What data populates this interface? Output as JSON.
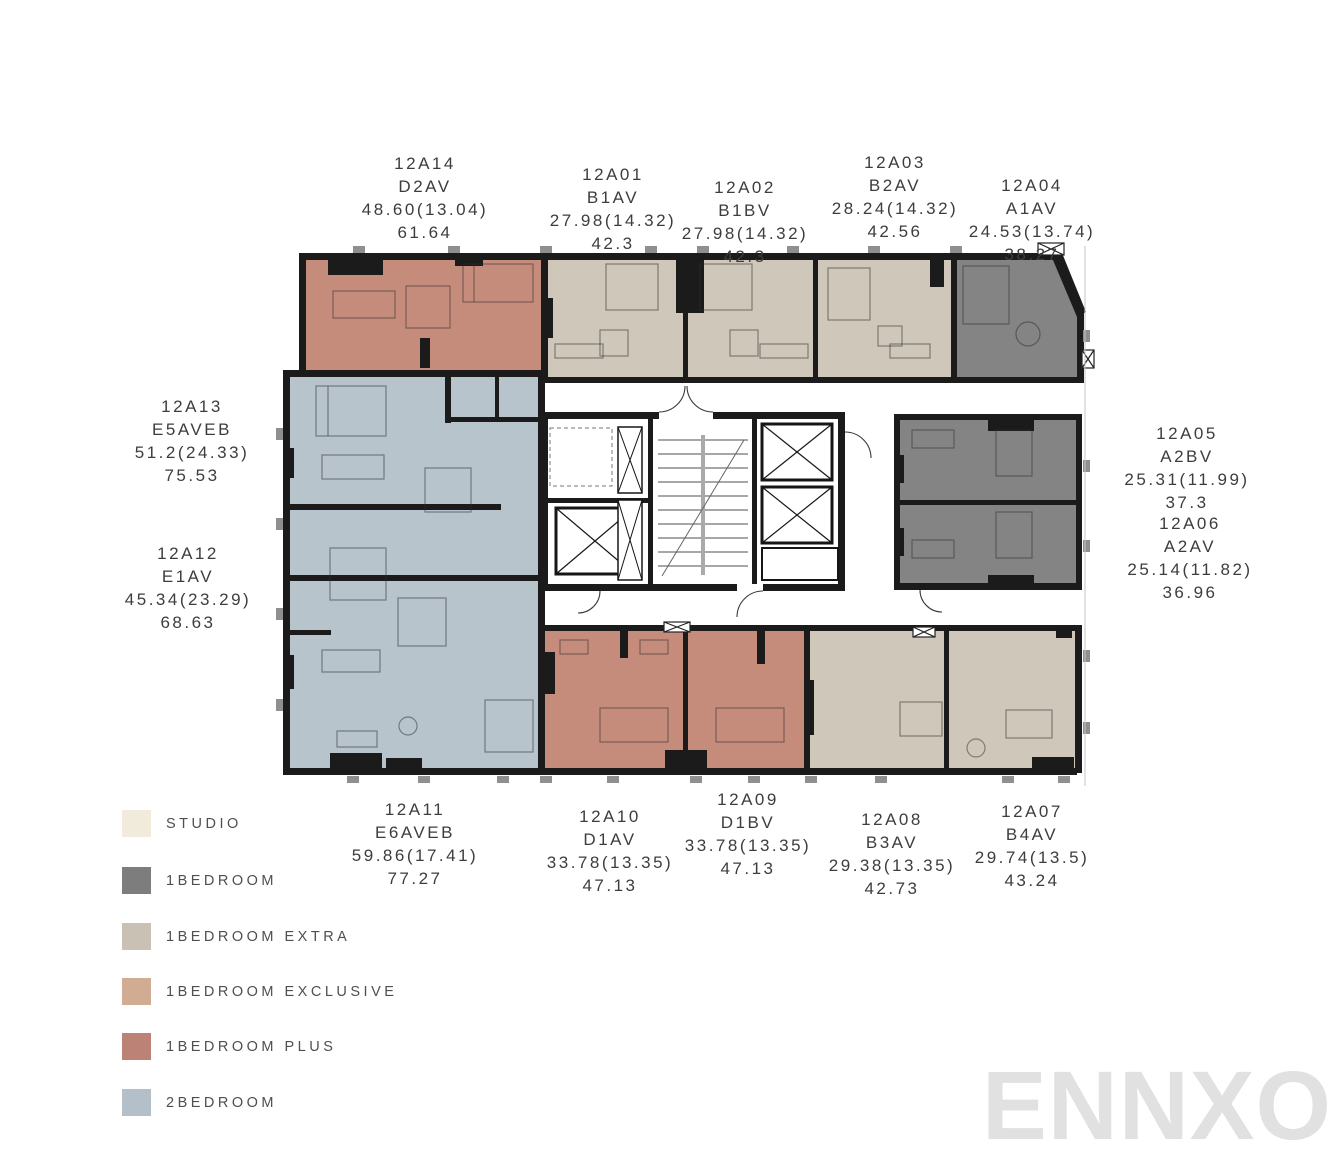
{
  "units": {
    "u01": {
      "id": "12A01",
      "type": "B1AV",
      "area": "27.98(14.32)",
      "total": "42.3"
    },
    "u02": {
      "id": "12A02",
      "type": "B1BV",
      "area": "27.98(14.32)",
      "total": "42.3"
    },
    "u03": {
      "id": "12A03",
      "type": "B2AV",
      "area": "28.24(14.32)",
      "total": "42.56"
    },
    "u04": {
      "id": "12A04",
      "type": "A1AV",
      "area": "24.53(13.74)",
      "total": "38.27"
    },
    "u05": {
      "id": "12A05",
      "type": "A2BV",
      "area": "25.31(11.99)",
      "total": "37.3"
    },
    "u06": {
      "id": "12A06",
      "type": "A2AV",
      "area": "25.14(11.82)",
      "total": "36.96"
    },
    "u07": {
      "id": "12A07",
      "type": "B4AV",
      "area": "29.74(13.5)",
      "total": "43.24"
    },
    "u08": {
      "id": "12A08",
      "type": "B3AV",
      "area": "29.38(13.35)",
      "total": "42.73"
    },
    "u09": {
      "id": "12A09",
      "type": "D1BV",
      "area": "33.78(13.35)",
      "total": "47.13"
    },
    "u10": {
      "id": "12A10",
      "type": "D1AV",
      "area": "33.78(13.35)",
      "total": "47.13"
    },
    "u11": {
      "id": "12A11",
      "type": "E6AVEB",
      "area": "59.86(17.41)",
      "total": "77.27"
    },
    "u12": {
      "id": "12A12",
      "type": "E1AV",
      "area": "45.34(23.29)",
      "total": "68.63"
    },
    "u13": {
      "id": "12A13",
      "type": "E5AVEB",
      "area": "51.2(24.33)",
      "total": "75.53"
    },
    "u14": {
      "id": "12A14",
      "type": "D2AV",
      "area": "48.60(13.04)",
      "total": "61.64"
    }
  },
  "legend": {
    "items": [
      {
        "label": "STUDIO",
        "color": "#f0ebdb"
      },
      {
        "label": "1BEDROOM",
        "color": "#7d7d7d"
      },
      {
        "label": "1BEDROOM EXTRA",
        "color": "#c9c1b3"
      },
      {
        "label": "1BEDROOM EXCLUSIVE",
        "color": "#d2ab93"
      },
      {
        "label": "1BEDROOM PLUS",
        "color": "#bb8275"
      },
      {
        "label": "2BEDROOM",
        "color": "#b3c0c9"
      }
    ]
  },
  "palette": {
    "wall": "#1b1b1b",
    "one_bedroom": "#848484",
    "one_bedroom_extra": "#cfc8ba",
    "one_bedroom_plus": "#c68c7b",
    "two_bedroom": "#b8c4cc"
  },
  "watermark": {
    "text": "ENNXO"
  }
}
